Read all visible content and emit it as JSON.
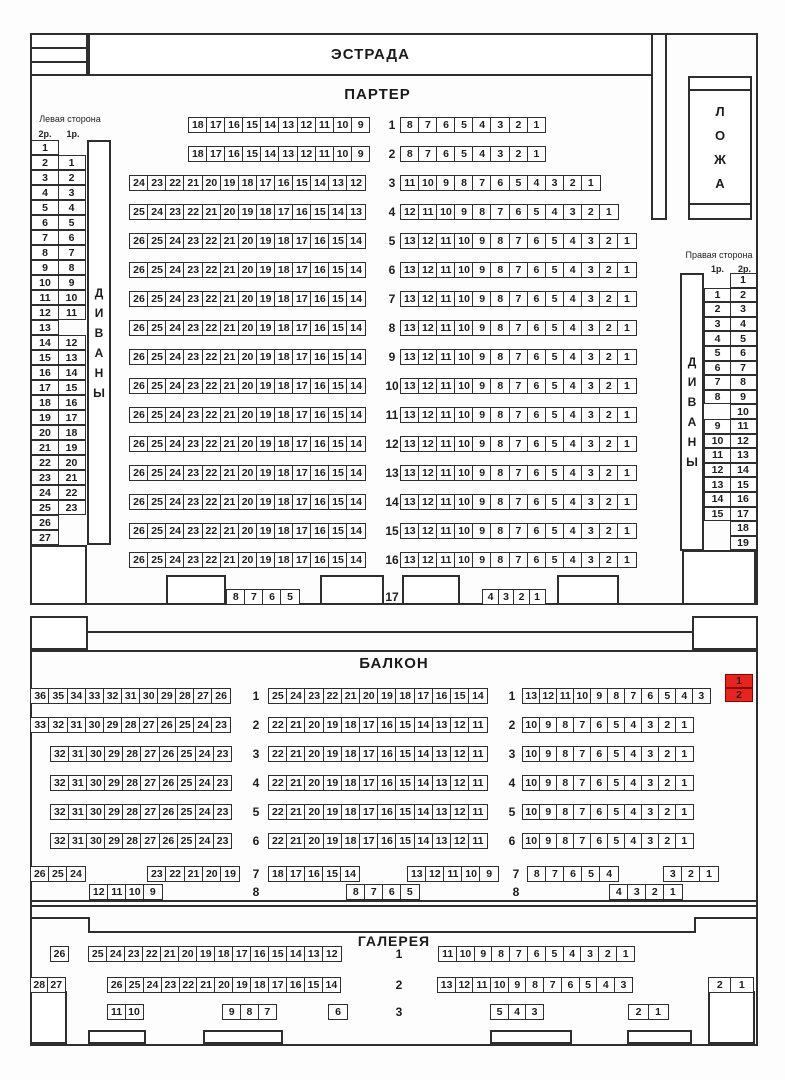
{
  "titles": {
    "stage": "ЭСТРАДА",
    "parterre": "ПАРТЕР",
    "balcony": "БАЛКОН",
    "gallery": "ГАЛЕРЕЯ"
  },
  "loge": {
    "word": "ЛОЖА",
    "letters": [
      "Л",
      "О",
      "Ж",
      "А"
    ]
  },
  "divans_word": "ДИВАНЫ",
  "divans_letters": [
    "Д",
    "И",
    "В",
    "А",
    "Н",
    "Ы"
  ],
  "left_side": {
    "label": "Левая сторона",
    "headers": [
      "2р.",
      "1р."
    ],
    "rows": [
      [
        "1",
        null
      ],
      [
        "2",
        "1"
      ],
      [
        "3",
        "2"
      ],
      [
        "4",
        "3"
      ],
      [
        "5",
        "4"
      ],
      [
        "6",
        "5"
      ],
      [
        "7",
        "6"
      ],
      [
        "8",
        "7"
      ],
      [
        "9",
        "8"
      ],
      [
        "10",
        "9"
      ],
      [
        "11",
        "10"
      ],
      [
        "12",
        "11"
      ],
      [
        "13",
        null
      ],
      [
        "14",
        "12"
      ],
      [
        "15",
        "13"
      ],
      [
        "16",
        "14"
      ],
      [
        "17",
        "15"
      ],
      [
        "18",
        "16"
      ],
      [
        "19",
        "17"
      ],
      [
        "20",
        "18"
      ],
      [
        "21",
        "19"
      ],
      [
        "22",
        "20"
      ],
      [
        "23",
        "21"
      ],
      [
        "24",
        "22"
      ],
      [
        "25",
        "23"
      ],
      [
        "26",
        null
      ],
      [
        "27",
        null
      ]
    ]
  },
  "right_side": {
    "label": "Правая сторона",
    "headers": [
      "1р.",
      "2р."
    ],
    "rows": [
      [
        null,
        "1"
      ],
      [
        "1",
        "2"
      ],
      [
        "2",
        "3"
      ],
      [
        "3",
        "4"
      ],
      [
        "4",
        "5"
      ],
      [
        "5",
        "6"
      ],
      [
        "6",
        "7"
      ],
      [
        "7",
        "8"
      ],
      [
        "8",
        "9"
      ],
      [
        null,
        "10"
      ],
      [
        "9",
        "11"
      ],
      [
        "10",
        "12"
      ],
      [
        "11",
        "13"
      ],
      [
        "12",
        "14"
      ],
      [
        "13",
        "15"
      ],
      [
        "14",
        "16"
      ],
      [
        "15",
        "17"
      ],
      [
        null,
        "18"
      ],
      [
        null,
        "19"
      ]
    ]
  },
  "parterre": {
    "rows": [
      {
        "n": "1",
        "left": [
          18,
          17,
          16,
          15,
          14,
          13,
          12,
          11,
          10,
          9
        ],
        "right": [
          8,
          7,
          6,
          5,
          4,
          3,
          2,
          1
        ]
      },
      {
        "n": "2",
        "left": [
          18,
          17,
          16,
          15,
          14,
          13,
          12,
          11,
          10,
          9
        ],
        "right": [
          8,
          7,
          6,
          5,
          4,
          3,
          2,
          1
        ]
      },
      {
        "n": "3",
        "left": [
          24,
          23,
          22,
          21,
          20,
          19,
          18,
          17,
          16,
          15,
          14,
          13,
          12
        ],
        "right": [
          11,
          10,
          9,
          8,
          7,
          6,
          5,
          4,
          3,
          2,
          1
        ]
      },
      {
        "n": "4",
        "left": [
          25,
          24,
          23,
          22,
          21,
          20,
          19,
          18,
          17,
          16,
          15,
          14,
          13
        ],
        "right": [
          12,
          11,
          10,
          9,
          8,
          7,
          6,
          5,
          4,
          3,
          2,
          1
        ]
      },
      {
        "n": "5",
        "left": [
          26,
          25,
          24,
          23,
          22,
          21,
          20,
          19,
          18,
          17,
          16,
          15,
          14
        ],
        "right": [
          13,
          12,
          11,
          10,
          9,
          8,
          7,
          6,
          5,
          4,
          3,
          2,
          1
        ]
      },
      {
        "n": "6",
        "left": [
          26,
          25,
          24,
          23,
          22,
          21,
          20,
          19,
          18,
          17,
          16,
          15,
          14
        ],
        "right": [
          13,
          12,
          11,
          10,
          9,
          8,
          7,
          6,
          5,
          4,
          3,
          2,
          1
        ]
      },
      {
        "n": "7",
        "left": [
          26,
          25,
          24,
          23,
          22,
          21,
          20,
          19,
          18,
          17,
          16,
          15,
          14
        ],
        "right": [
          13,
          12,
          11,
          10,
          9,
          8,
          7,
          6,
          5,
          4,
          3,
          2,
          1
        ]
      },
      {
        "n": "8",
        "left": [
          26,
          25,
          24,
          23,
          22,
          21,
          20,
          19,
          18,
          17,
          16,
          15,
          14
        ],
        "right": [
          13,
          12,
          11,
          10,
          9,
          8,
          7,
          6,
          5,
          4,
          3,
          2,
          1
        ]
      },
      {
        "n": "9",
        "left": [
          26,
          25,
          24,
          23,
          22,
          21,
          20,
          19,
          18,
          17,
          16,
          15,
          14
        ],
        "right": [
          13,
          12,
          11,
          10,
          9,
          8,
          7,
          6,
          5,
          4,
          3,
          2,
          1
        ]
      },
      {
        "n": "10",
        "left": [
          26,
          25,
          24,
          23,
          22,
          21,
          20,
          19,
          18,
          17,
          16,
          15,
          14
        ],
        "right": [
          13,
          12,
          11,
          10,
          9,
          8,
          7,
          6,
          5,
          4,
          3,
          2,
          1
        ]
      },
      {
        "n": "11",
        "left": [
          26,
          25,
          24,
          23,
          22,
          21,
          20,
          19,
          18,
          17,
          16,
          15,
          14
        ],
        "right": [
          13,
          12,
          11,
          10,
          9,
          8,
          7,
          6,
          5,
          4,
          3,
          2,
          1
        ]
      },
      {
        "n": "12",
        "left": [
          26,
          25,
          24,
          23,
          22,
          21,
          20,
          19,
          18,
          17,
          16,
          15,
          14
        ],
        "right": [
          13,
          12,
          11,
          10,
          9,
          8,
          7,
          6,
          5,
          4,
          3,
          2,
          1
        ]
      },
      {
        "n": "13",
        "left": [
          26,
          25,
          24,
          23,
          22,
          21,
          20,
          19,
          18,
          17,
          16,
          15,
          14
        ],
        "right": [
          13,
          12,
          11,
          10,
          9,
          8,
          7,
          6,
          5,
          4,
          3,
          2,
          1
        ]
      },
      {
        "n": "14",
        "left": [
          26,
          25,
          24,
          23,
          22,
          21,
          20,
          19,
          18,
          17,
          16,
          15,
          14
        ],
        "right": [
          13,
          12,
          11,
          10,
          9,
          8,
          7,
          6,
          5,
          4,
          3,
          2,
          1
        ]
      },
      {
        "n": "15",
        "left": [
          26,
          25,
          24,
          23,
          22,
          21,
          20,
          19,
          18,
          17,
          16,
          15,
          14
        ],
        "right": [
          13,
          12,
          11,
          10,
          9,
          8,
          7,
          6,
          5,
          4,
          3,
          2,
          1
        ]
      },
      {
        "n": "16",
        "left": [
          26,
          25,
          24,
          23,
          22,
          21,
          20,
          19,
          18,
          17,
          16,
          15,
          14
        ],
        "right": [
          13,
          12,
          11,
          10,
          9,
          8,
          7,
          6,
          5,
          4,
          3,
          2,
          1
        ]
      }
    ],
    "row17": {
      "n": "17",
      "left": [
        8,
        7,
        6,
        5
      ],
      "right": [
        4,
        3,
        2,
        1
      ]
    }
  },
  "balcony": {
    "rows": [
      {
        "n": "1",
        "left": [
          36,
          35,
          34,
          33,
          32,
          31,
          30,
          29,
          28,
          27,
          26
        ],
        "mid": [
          25,
          24,
          23,
          22,
          21,
          20,
          19,
          18,
          17,
          16,
          15,
          14
        ],
        "right": [
          13,
          12,
          11,
          10,
          9,
          8,
          7,
          6,
          5,
          4,
          3
        ]
      },
      {
        "n": "2",
        "left": [
          33,
          32,
          31,
          30,
          29,
          28,
          27,
          26,
          25,
          24,
          23
        ],
        "mid": [
          22,
          21,
          20,
          19,
          18,
          17,
          16,
          15,
          14,
          13,
          12,
          11
        ],
        "right": [
          10,
          9,
          8,
          7,
          6,
          5,
          4,
          3,
          2,
          1
        ]
      },
      {
        "n": "3",
        "left": [
          32,
          31,
          30,
          29,
          28,
          27,
          26,
          25,
          24,
          23
        ],
        "mid": [
          22,
          21,
          20,
          19,
          18,
          17,
          16,
          15,
          14,
          13,
          12,
          11
        ],
        "right": [
          10,
          9,
          8,
          7,
          6,
          5,
          4,
          3,
          2,
          1
        ]
      },
      {
        "n": "4",
        "left": [
          32,
          31,
          30,
          29,
          28,
          27,
          26,
          25,
          24,
          23
        ],
        "mid": [
          22,
          21,
          20,
          19,
          18,
          17,
          16,
          15,
          14,
          13,
          12,
          11
        ],
        "right": [
          10,
          9,
          8,
          7,
          6,
          5,
          4,
          3,
          2,
          1
        ]
      },
      {
        "n": "5",
        "left": [
          32,
          31,
          30,
          29,
          28,
          27,
          26,
          25,
          24,
          23
        ],
        "mid": [
          22,
          21,
          20,
          19,
          18,
          17,
          16,
          15,
          14,
          13,
          12,
          11
        ],
        "right": [
          10,
          9,
          8,
          7,
          6,
          5,
          4,
          3,
          2,
          1
        ]
      },
      {
        "n": "6",
        "left": [
          32,
          31,
          30,
          29,
          28,
          27,
          26,
          25,
          24,
          23
        ],
        "mid": [
          22,
          21,
          20,
          19,
          18,
          17,
          16,
          15,
          14,
          13,
          12,
          11
        ],
        "right": [
          10,
          9,
          8,
          7,
          6,
          5,
          4,
          3,
          2,
          1
        ]
      }
    ],
    "selected": {
      "row": "1",
      "seats": [
        1,
        2
      ],
      "status": "selected"
    },
    "row7": {
      "n": "7",
      "groups": [
        [
          26,
          25,
          24
        ],
        [
          23,
          22,
          21,
          20,
          19
        ],
        [
          18,
          17,
          16,
          15,
          14
        ],
        [
          13,
          12,
          11,
          10,
          9
        ],
        [
          8,
          7,
          6,
          5,
          4
        ],
        [
          3,
          2,
          1
        ]
      ]
    },
    "row8": {
      "n": "8",
      "groups": [
        [
          12,
          11,
          10,
          9
        ],
        [
          8,
          7,
          6,
          5
        ],
        [
          4,
          3,
          2,
          1
        ]
      ]
    }
  },
  "gallery": {
    "row1": {
      "n": "1",
      "solo": [
        26
      ],
      "main": [
        25,
        24,
        23,
        22,
        21,
        20,
        19,
        18,
        17,
        16,
        15,
        14,
        13,
        12
      ],
      "right": [
        11,
        10,
        9,
        8,
        7,
        6,
        5,
        4,
        3,
        2,
        1
      ]
    },
    "row2": {
      "n": "2",
      "far_left": [
        28,
        27
      ],
      "main": [
        26,
        25,
        24,
        23,
        22,
        21,
        20,
        19,
        18,
        17,
        16,
        15,
        14
      ],
      "right": [
        13,
        12,
        11,
        10,
        9,
        8,
        7,
        6,
        5,
        4,
        3
      ],
      "far_right": [
        2,
        1
      ]
    },
    "row3": {
      "n": "3",
      "groups": [
        [
          11,
          10
        ],
        [
          9,
          8,
          7
        ],
        [
          6
        ],
        [
          5,
          4,
          3
        ],
        [
          2,
          1
        ]
      ]
    }
  },
  "colors": {
    "line": "#2e2e2e",
    "seat_fill": "#ffffff",
    "selected_fill": "#e8251d",
    "selected_border": "#8e0000",
    "background": "#fdfdfd"
  }
}
